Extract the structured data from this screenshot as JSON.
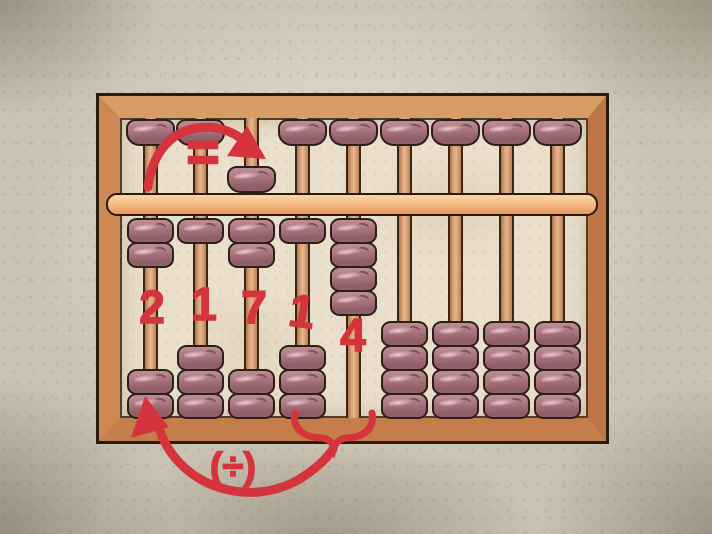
{
  "illustration": {
    "alt": "Hand-drawn wooden abacus on mottled paper with red division annotations"
  },
  "abacus": {
    "rod_count": 9,
    "upper_beads_per_rod": 1,
    "lower_beads_per_rod": 4,
    "value_shown": "21714",
    "columns": [
      {
        "index": 1,
        "digit_label": "2",
        "upper_bead": "up",
        "lower_beads_raised": 2,
        "lower_beads_rest": 2
      },
      {
        "index": 2,
        "digit_label": "1",
        "upper_bead": "up",
        "lower_beads_raised": 1,
        "lower_beads_rest": 3
      },
      {
        "index": 3,
        "digit_label": "7",
        "upper_bead": "down",
        "lower_beads_raised": 2,
        "lower_beads_rest": 2
      },
      {
        "index": 4,
        "digit_label": "1",
        "upper_bead": "up",
        "lower_beads_raised": 1,
        "lower_beads_rest": 3
      },
      {
        "index": 5,
        "digit_label": "4",
        "upper_bead": "up",
        "lower_beads_raised": 4,
        "lower_beads_rest": 0
      },
      {
        "index": 6,
        "digit_label": "",
        "upper_bead": "up",
        "lower_beads_raised": 0,
        "lower_beads_rest": 4
      },
      {
        "index": 7,
        "digit_label": "",
        "upper_bead": "up",
        "lower_beads_raised": 0,
        "lower_beads_rest": 4
      },
      {
        "index": 8,
        "digit_label": "",
        "upper_bead": "up",
        "lower_beads_raised": 0,
        "lower_beads_rest": 4
      },
      {
        "index": 9,
        "digit_label": "",
        "upper_bead": "up",
        "lower_beads_raised": 0,
        "lower_beads_rest": 4
      }
    ]
  },
  "annotations": {
    "equals_symbol": "=",
    "division_symbol": "(÷)"
  },
  "colors": {
    "annotation_red": "#d5343c",
    "bead_base": "#a7737d",
    "frame_wood": "#c8834f",
    "beam_wood": "#f3b87e",
    "rod_wood": "#dca87f",
    "inner_background": "#eadfcb",
    "paper_background": "#cac3b4"
  }
}
